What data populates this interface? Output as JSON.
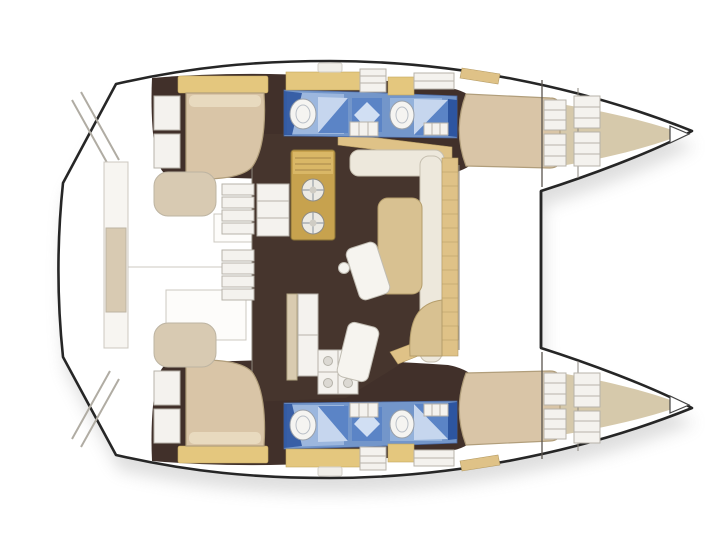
{
  "figure": {
    "type": "boat-floor-plan",
    "subject": "catamaran yacht interior layout, top view, bows pointing right",
    "hulls": 2,
    "cabins": 4,
    "bathrooms": 4
  },
  "colors": {
    "outline": "#262626",
    "interior_brown": "#41302a",
    "salon_brown": "#46352d",
    "bed_beige": "#d9c5a7",
    "bed_border": "#b19e7b",
    "pillow": "#e8dabf",
    "headboard_tan": "#e4c77e",
    "furniture_white": "#f4f2ee",
    "furniture_border": "#b7b3aa",
    "galley_gold": "#c7a24e",
    "galley_border": "#8a7336",
    "seat_cream": "#ede8dc",
    "seat_tan": "#d8c191",
    "band_tan": "#dfc287",
    "forepeak_beige": "#d6c9ab",
    "bath_blue": "#7396ca",
    "bath_blue_light": "#a3bde2",
    "bath_blue_dark": "#2d55a0",
    "shower_light": "#c6d6ee",
    "shower_mid": "#5b84c6",
    "bench_beige": "#d8cab2",
    "shadow": "#8a8a8a"
  },
  "legend": [
    {
      "id": "hull-outline",
      "kind": "boat-perimeter"
    },
    {
      "id": "forward-crossbeam",
      "kind": "structure"
    },
    {
      "id": "port-transom-steps",
      "kind": "stern-steps"
    },
    {
      "id": "starboard-transom-steps",
      "kind": "stern-steps"
    },
    {
      "id": "aft-platform",
      "kind": "deck"
    },
    {
      "id": "aft-cockpit",
      "kind": "deck-seating"
    },
    {
      "id": "salon-floor",
      "kind": "interior-floor"
    },
    {
      "id": "galley",
      "kind": "counter-with-burners"
    },
    {
      "id": "salon-dinette",
      "kind": "sofa-table-chairs"
    },
    {
      "id": "forward-sideboard",
      "kind": "bench"
    },
    {
      "id": "companionway-steps-port",
      "kind": "stairs"
    },
    {
      "id": "companionway-steps-starboard",
      "kind": "stairs"
    },
    {
      "id": "port-aft-cabin",
      "kind": "double-berth"
    },
    {
      "id": "starboard-aft-cabin",
      "kind": "double-berth"
    },
    {
      "id": "port-bathrooms",
      "kind": "head-shower-sink-toilet"
    },
    {
      "id": "starboard-bathrooms",
      "kind": "head-shower-sink-toilet"
    },
    {
      "id": "port-bow-cabin",
      "kind": "double-berth-with-lockers"
    },
    {
      "id": "starboard-bow-cabin",
      "kind": "double-berth-with-lockers"
    },
    {
      "id": "port-forepeak",
      "kind": "bow-storage"
    },
    {
      "id": "starboard-forepeak",
      "kind": "bow-storage"
    },
    {
      "id": "bow-anchor-locker",
      "kind": "locker"
    }
  ]
}
